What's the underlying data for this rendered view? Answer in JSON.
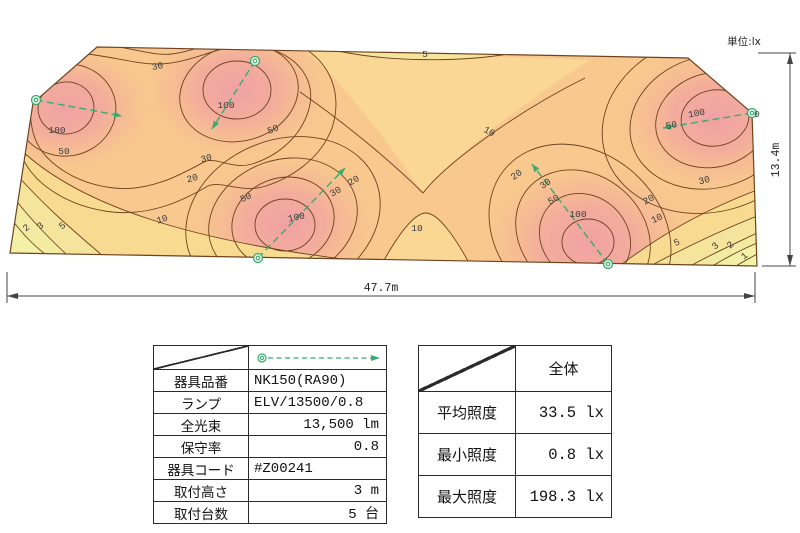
{
  "unit_label": "単位:lx",
  "dimensions": {
    "width": "47.7m",
    "height": "13.4m"
  },
  "chart_data": {
    "type": "heatmap",
    "subtype": "illuminance-contour-map",
    "unit": "lx",
    "area_width_m": 47.7,
    "area_height_m": 13.4,
    "contour_levels": [
      1,
      2,
      3,
      5,
      10,
      20,
      30,
      50,
      100
    ],
    "outline_px": [
      [
        97,
        47
      ],
      [
        688,
        58
      ],
      [
        752,
        113
      ],
      [
        757,
        266
      ],
      [
        10,
        253
      ],
      [
        33,
        103
      ]
    ],
    "stats": {
      "average_lx": 33.5,
      "min_lx": 0.8,
      "max_lx": 198.3
    },
    "luminaire_count": 5,
    "mounting_height_m": 3,
    "luminaires_px": [
      {
        "x": 36,
        "y": 100,
        "ax": 122,
        "ay": 116
      },
      {
        "x": 255,
        "y": 61,
        "ax": 212,
        "ay": 129
      },
      {
        "x": 258,
        "y": 258,
        "ax": 345,
        "ay": 168
      },
      {
        "x": 608,
        "y": 264,
        "ax": 532,
        "ay": 164
      },
      {
        "x": 752,
        "y": 113,
        "ax": 663,
        "ay": 128
      }
    ],
    "contour_labels": [
      {
        "v": "30",
        "x": 158,
        "y": 69,
        "r": -10
      },
      {
        "v": "5",
        "x": 425,
        "y": 57,
        "r": 0
      },
      {
        "v": "10",
        "x": 488,
        "y": 134,
        "r": 28
      },
      {
        "v": "100",
        "x": 226,
        "y": 108,
        "r": 0
      },
      {
        "v": "50",
        "x": 274,
        "y": 132,
        "r": -22
      },
      {
        "v": "100",
        "x": 57,
        "y": 133,
        "r": 0
      },
      {
        "v": "50",
        "x": 64,
        "y": 154,
        "r": 0
      },
      {
        "v": "30",
        "x": 207,
        "y": 161,
        "r": -15
      },
      {
        "v": "20",
        "x": 193,
        "y": 181,
        "r": -15
      },
      {
        "v": "10",
        "x": 163,
        "y": 222,
        "r": -18
      },
      {
        "v": "2",
        "x": 28,
        "y": 230,
        "r": -38
      },
      {
        "v": "3",
        "x": 42,
        "y": 228,
        "r": -38
      },
      {
        "v": "5",
        "x": 64,
        "y": 228,
        "r": -38
      },
      {
        "v": "20",
        "x": 355,
        "y": 183,
        "r": -30
      },
      {
        "v": "30",
        "x": 337,
        "y": 194,
        "r": -30
      },
      {
        "v": "50",
        "x": 247,
        "y": 200,
        "r": -25
      },
      {
        "v": "100",
        "x": 297,
        "y": 220,
        "r": -12
      },
      {
        "v": "10",
        "x": 417,
        "y": 231,
        "r": 0
      },
      {
        "v": "20",
        "x": 518,
        "y": 177,
        "r": -35
      },
      {
        "v": "30",
        "x": 547,
        "y": 186,
        "r": -35
      },
      {
        "v": "50",
        "x": 555,
        "y": 202,
        "r": -30
      },
      {
        "v": "100",
        "x": 578,
        "y": 217,
        "r": 0
      },
      {
        "v": "30",
        "x": 705,
        "y": 183,
        "r": -15
      },
      {
        "v": "20",
        "x": 650,
        "y": 202,
        "r": -30
      },
      {
        "v": "10",
        "x": 658,
        "y": 221,
        "r": -25
      },
      {
        "v": "5",
        "x": 678,
        "y": 245,
        "r": -25
      },
      {
        "v": "3",
        "x": 717,
        "y": 248,
        "r": -40
      },
      {
        "v": "2",
        "x": 732,
        "y": 247,
        "r": -40
      },
      {
        "v": "1",
        "x": 746,
        "y": 258,
        "r": -40
      },
      {
        "v": "50",
        "x": 672,
        "y": 128,
        "r": -12
      },
      {
        "v": "100",
        "x": 697,
        "y": 116,
        "r": -10
      },
      {
        "v": "0",
        "x": 757,
        "y": 117,
        "r": 0
      }
    ],
    "colors": {
      "base": "#F8C88E",
      "valley": "#FAD795",
      "peak_inner": "#F0A1A4",
      "yellow_bands": [
        "#F8DA91",
        "#F5E59C",
        "#F4EBA2",
        "#F3F0A7",
        "#F2F3AB"
      ],
      "contour_line": "#6E431F",
      "luminaire_green": "#3BAA6E"
    }
  },
  "fixture_table": {
    "rows": [
      {
        "label": "器具品番",
        "value": "NK150(RA90)",
        "align": "l"
      },
      {
        "label": "ランプ",
        "value": "ELV/13500/0.8",
        "align": "l"
      },
      {
        "label": "全光束",
        "value": "13,500 lm",
        "align": "r"
      },
      {
        "label": "保守率",
        "value": "0.8",
        "align": "r"
      },
      {
        "label": "器具コード",
        "value": "#Z00241",
        "align": "l"
      },
      {
        "label": "取付高さ",
        "value": "3 m",
        "align": "r"
      },
      {
        "label": "取付台数",
        "value": "5 台",
        "align": "r"
      }
    ]
  },
  "results_table": {
    "header": "全体",
    "rows": [
      {
        "label": "平均照度",
        "value": "33.5 lx"
      },
      {
        "label": "最小照度",
        "value": "0.8 lx"
      },
      {
        "label": "最大照度",
        "value": "198.3 lx"
      }
    ]
  }
}
